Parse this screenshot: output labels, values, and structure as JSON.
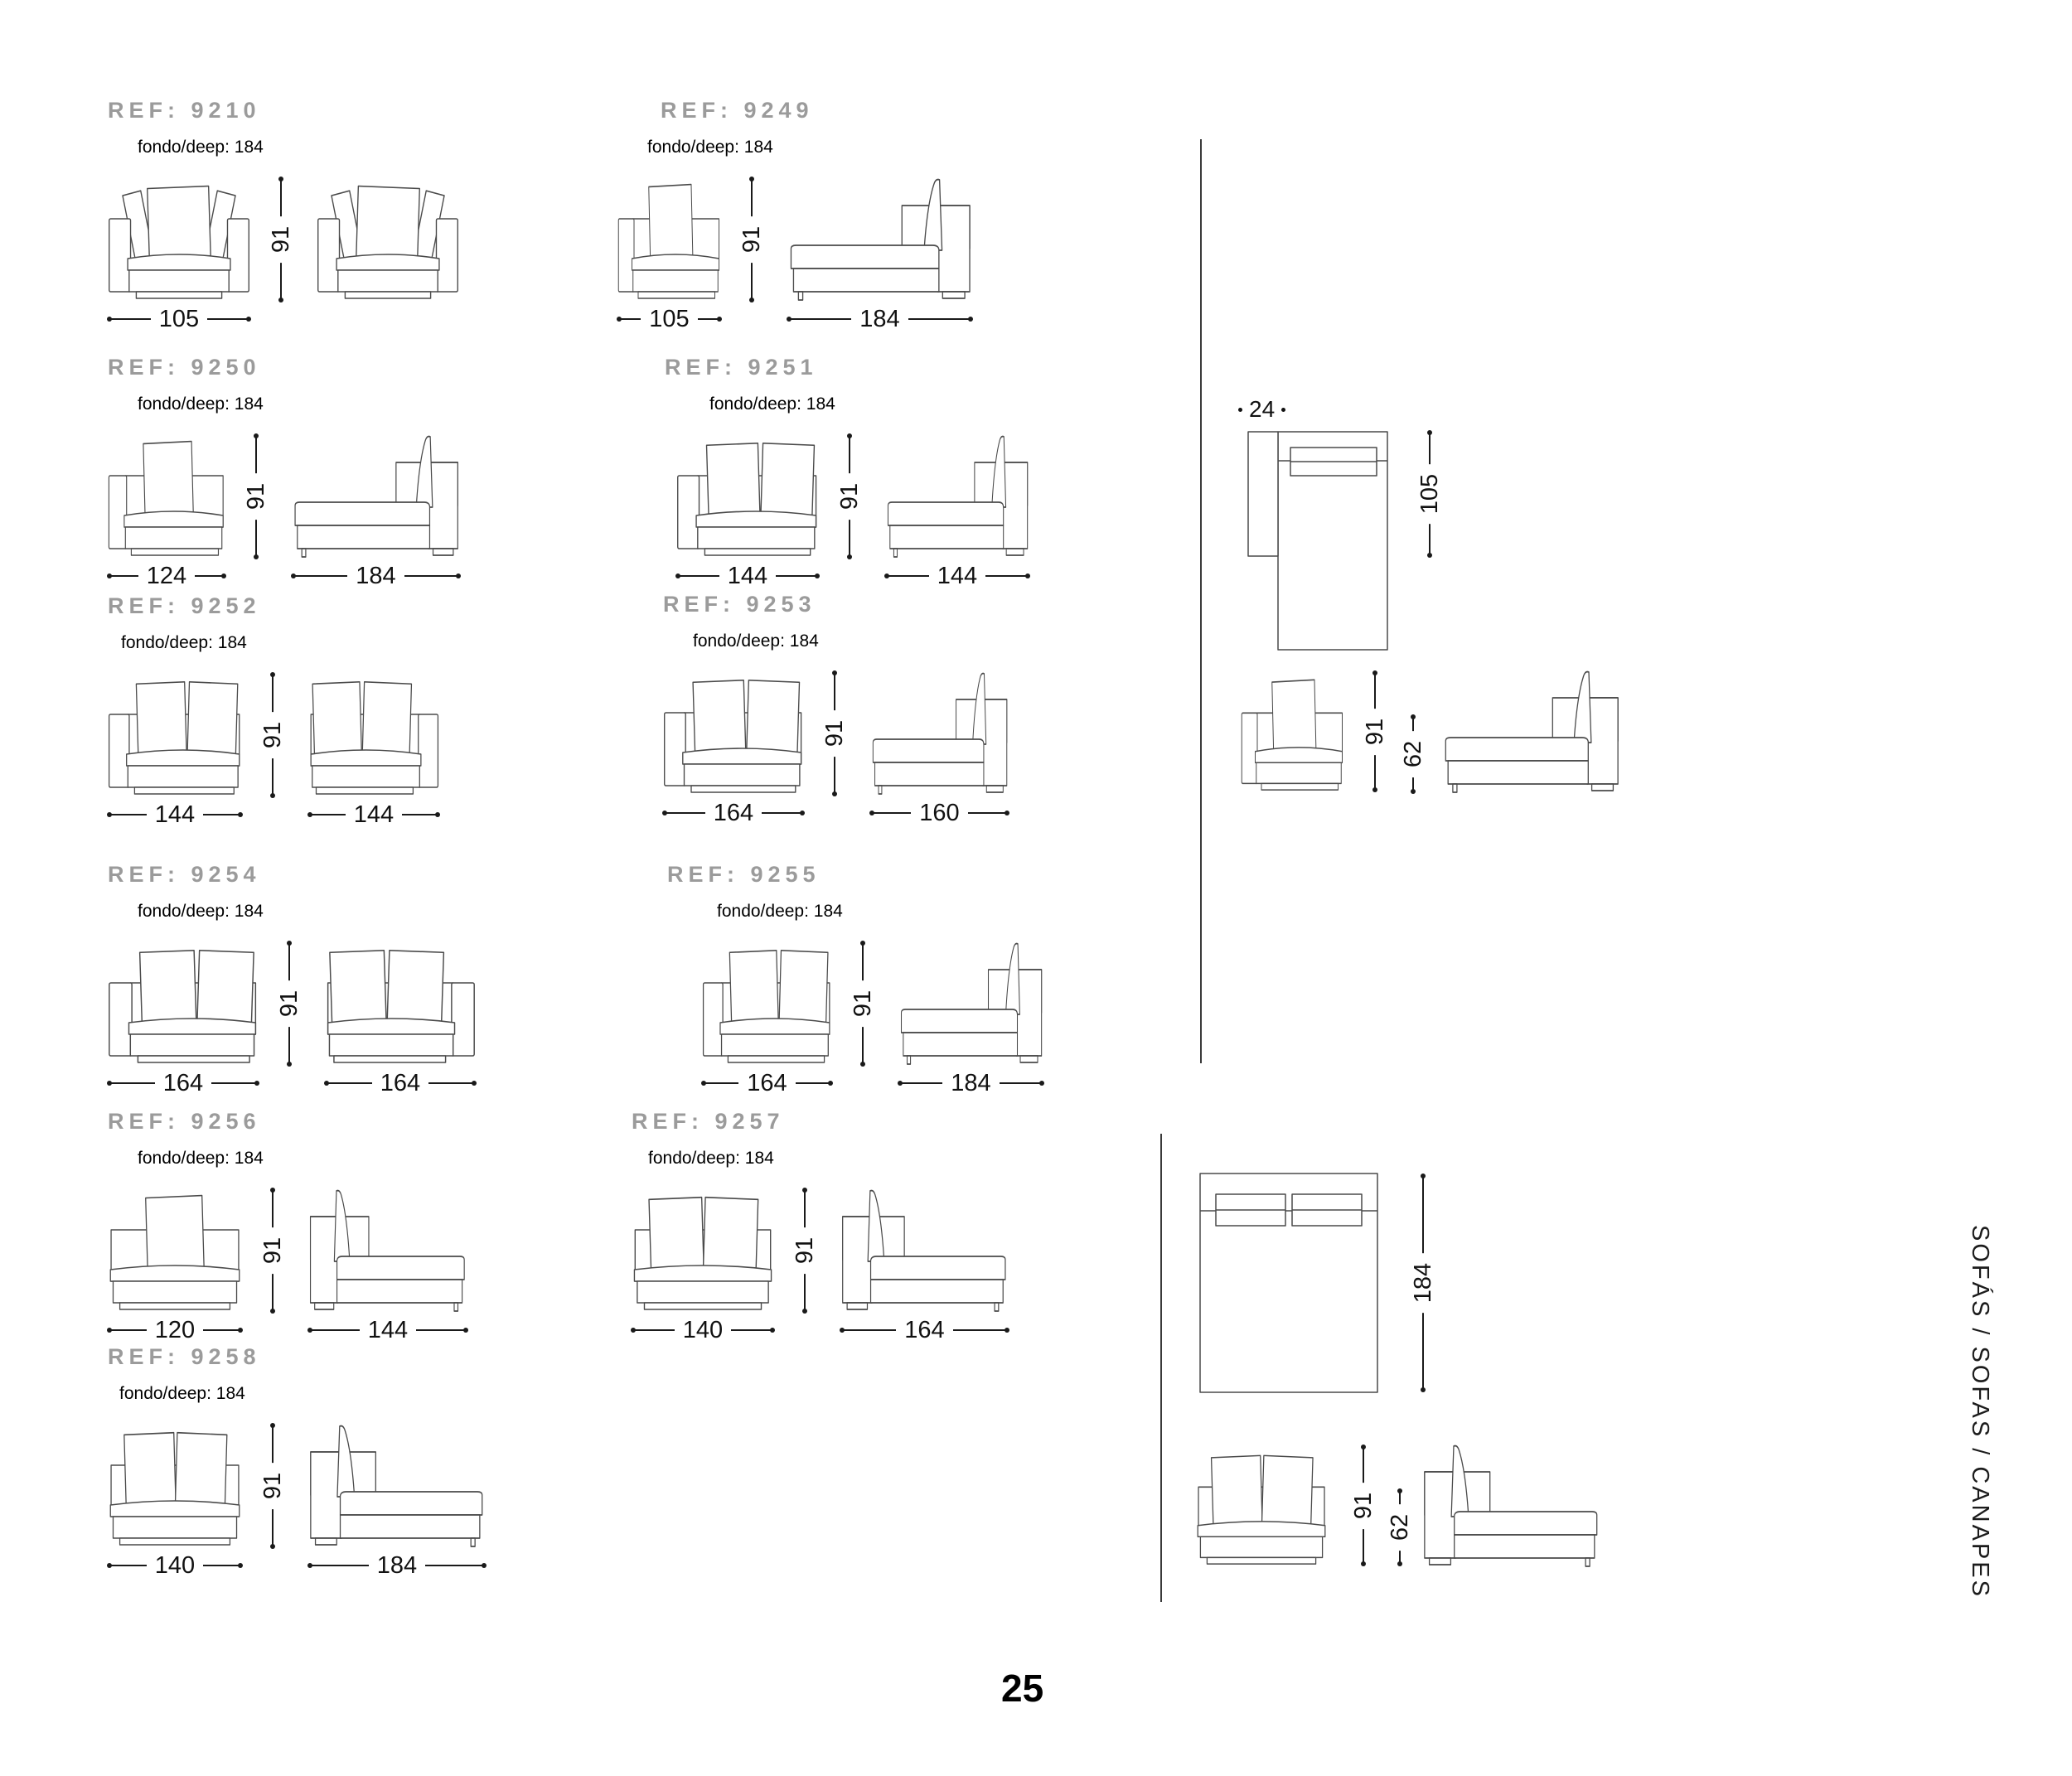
{
  "page": {
    "number": "25",
    "vertical_label": "SOFÁS / SOFAS / CANAPES"
  },
  "sections": [
    {
      "ref": "REF: 9210",
      "fondo": "fondo/deep: 184",
      "h": "91",
      "d1": "105"
    },
    {
      "ref": "REF: 9249",
      "fondo": "fondo/deep: 184",
      "h": "91",
      "d1": "105",
      "d2": "184"
    },
    {
      "ref": "REF: 9250",
      "fondo": "fondo/deep: 184",
      "h": "91",
      "d1": "124",
      "d2": "184"
    },
    {
      "ref": "REF: 9251",
      "fondo": "fondo/deep: 184",
      "h": "91",
      "d1": "144",
      "d2": "144"
    },
    {
      "ref": "REF: 9252",
      "fondo": "fondo/deep: 184",
      "h": "91",
      "d1": "144",
      "d2": "144"
    },
    {
      "ref": "REF: 9253",
      "fondo": "fondo/deep: 184",
      "h": "91",
      "d1": "164",
      "d2": "160"
    },
    {
      "ref": "REF: 9254",
      "fondo": "fondo/deep: 184",
      "h": "91",
      "d1": "164",
      "d2": "164"
    },
    {
      "ref": "REF: 9255",
      "fondo": "fondo/deep: 184",
      "h": "91",
      "d1": "164",
      "d2": "184"
    },
    {
      "ref": "REF: 9256",
      "fondo": "fondo/deep: 184",
      "h": "91",
      "d1": "120",
      "d2": "144"
    },
    {
      "ref": "REF: 9257",
      "fondo": "fondo/deep: 184",
      "h": "91",
      "d1": "140",
      "d2": "164"
    },
    {
      "ref": "REF: 9258",
      "fondo": "fondo/deep: 184",
      "h": "91",
      "d1": "140",
      "d2": "184"
    }
  ],
  "right_top": {
    "arm_width": "24",
    "arm_depth": "105",
    "height": "91",
    "seat_height": "62"
  },
  "right_bottom": {
    "depth": "184",
    "height": "91",
    "seat_height": "62"
  }
}
